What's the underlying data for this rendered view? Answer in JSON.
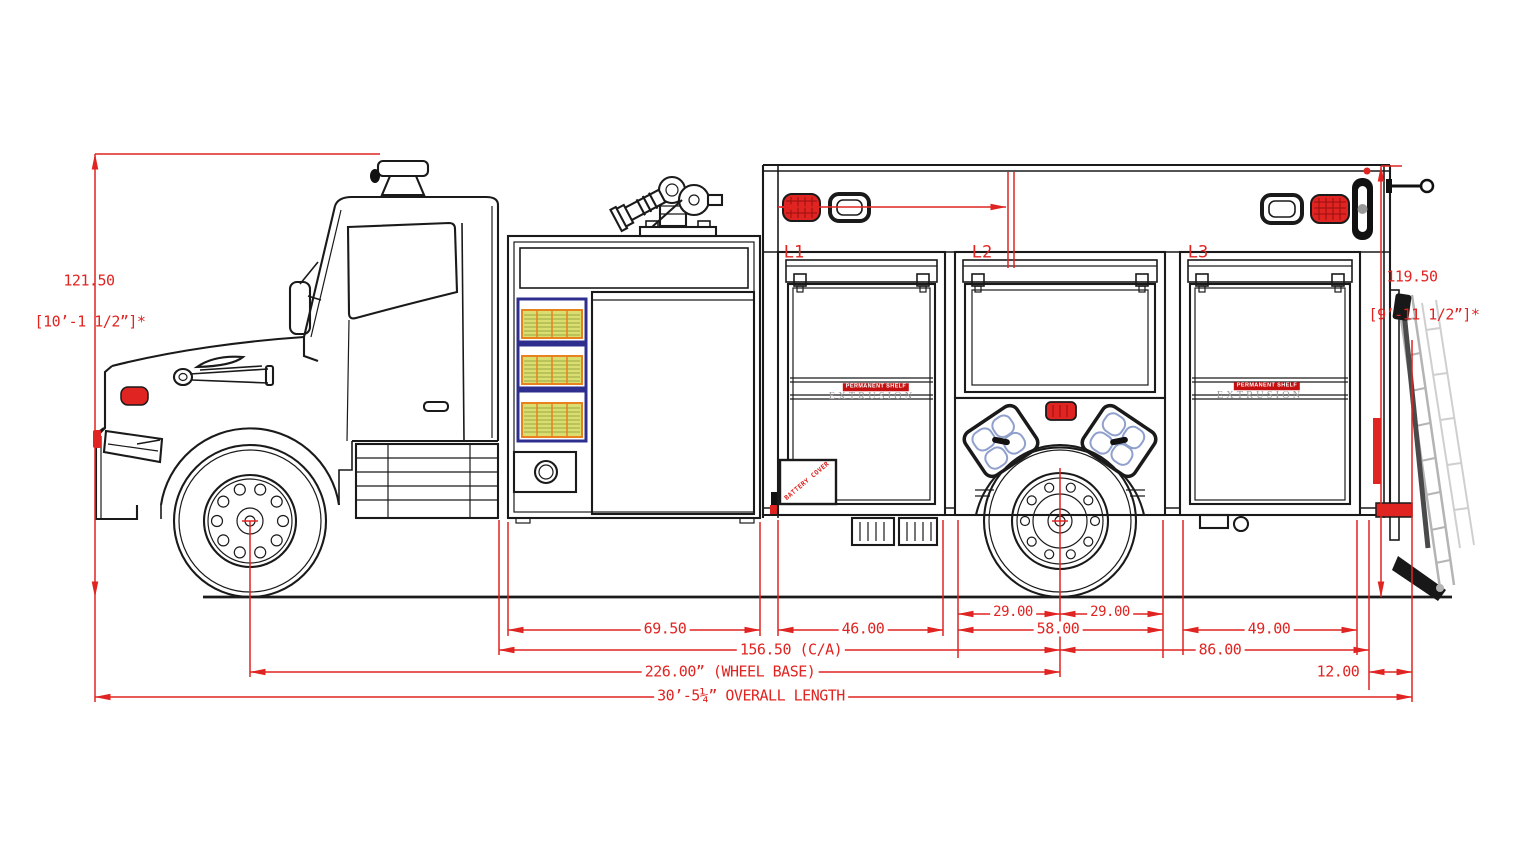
{
  "dims": {
    "height_left_in": "121.50",
    "height_left_ftin": "[10’-1 1/2”]*",
    "height_right_in": "119.50",
    "height_right_ftin": "[9’-11 1/2”]*",
    "pump_module_width": "69.50",
    "l1_width": "46.00",
    "well_front_half": "29.00",
    "well_rear_half": "29.00",
    "wheel_well_width": "58.00",
    "l3_width": "49.00",
    "cab_to_axle": "156.50 (C/A)",
    "axle_to_body_rear": "86.00",
    "wheel_base": "226.00” (WHEEL BASE)",
    "rear_overhang": "12.00",
    "overall_length": "30’-5¼” OVERALL LENGTH"
  },
  "compartments": {
    "l1": "L1",
    "l2": "L2",
    "l3": "L3"
  },
  "labels": {
    "permanent_shelf_l1": "PERMANENT SHELF",
    "extrusion_l1": "EXTRUSION",
    "permanent_shelf_l3": "PERMANENT SHELF",
    "extrusion_l3": "EXTRUSION",
    "battery_cover": "BATTERY COVER"
  },
  "colors": {
    "dimension_red": "#e02421",
    "line_black": "#1a1a1a",
    "tray_navy": "#2e2e8f",
    "hose_orange": "#e8821e",
    "hose_yellow": "#dade70",
    "ladder_gray": "#b4b4b4"
  }
}
